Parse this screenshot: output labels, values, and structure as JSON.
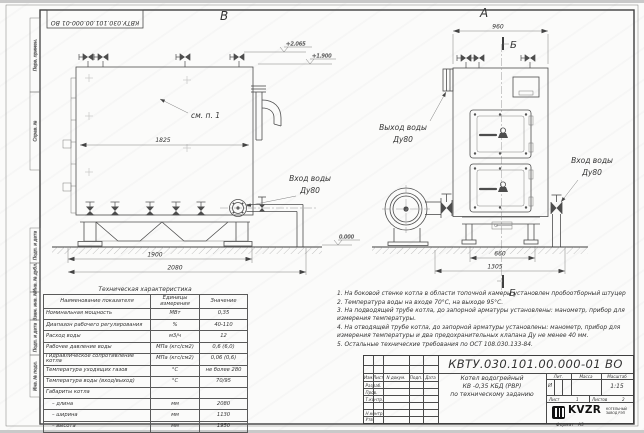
{
  "margin_fields": {
    "perv_primen": "Перв. примен.",
    "sprav_no": "Справ. №",
    "podp_data_1": "Подп. и дата",
    "inv_dubl": "Инв. № дубл.",
    "vzam_inv": "Взам. инв. №",
    "podp_data_2": "Подп. и дата",
    "inv_podl": "Инв. № подл."
  },
  "drawing": {
    "view_b_label": "В",
    "view_a_label": "А",
    "section_label": "Б",
    "see_note": "см. п. 1",
    "labels": {
      "inlet_line1": "Вход воды",
      "outlet_line1": "Выход воды",
      "dn": "Ду80"
    },
    "dims": {
      "d1825": "1825",
      "d1900": "1900",
      "d2080": "2080",
      "d960": "960",
      "d660": "660",
      "d1305": "1305"
    },
    "elevations": {
      "top": "+2.065",
      "mid": "+1.900",
      "ground": "0.000"
    }
  },
  "tech_table": {
    "title": "Техническая характеристика",
    "headers": [
      "Наименование показателя",
      "Единицы измерения",
      "Значение"
    ],
    "rows": [
      [
        "Номинальная мощность",
        "МВт",
        "0,35"
      ],
      [
        "Диапазон рабочего регулирования",
        "%",
        "40-110"
      ],
      [
        "Расход воды",
        "м3/ч",
        "12"
      ],
      [
        "Рабочее давление воды",
        "МПа (кгс/см2)",
        "0,6 (6,0)"
      ],
      [
        "Гидравлическое сопротивление котла",
        "МПа (кгс/см2)",
        "0,06 (0,6)"
      ],
      [
        "Температура уходящих газов",
        "°С",
        "не более 280"
      ],
      [
        "Температура воды (вход/выход)",
        "°С",
        "70/95"
      ],
      [
        "Габариты котла",
        "",
        ""
      ],
      [
        "– длина",
        "мм",
        "2080"
      ],
      [
        "– ширина",
        "мм",
        "1130"
      ],
      [
        "– высота",
        "мм",
        "1950"
      ]
    ]
  },
  "notes": [
    "1. На боковой стенке котла в области топочной камеры установлен пробоотборный штуцер",
    "2. Температура воды на входе 70°С, на выходе 95°С.",
    "3. На подводящей трубе котла, до запорной арматуры установлены: манометр, прибор для измерения температуры.",
    "4. На отводящей трубе котла, до запорной арматуры установлены: манометр, прибор для измерения температуры и два предохранительных клапана Ду не менее 40 мм.",
    "5. Остальные технические требования по ОСТ 108.030.133-84."
  ],
  "title_block": {
    "doc_number": "КВТУ.030.101.00.000-01 ВО",
    "change_cols": [
      "Изм.",
      "Лист",
      "N докум.",
      "Подп.",
      "Дата"
    ],
    "row_labels": [
      "Разраб.",
      "Пров.",
      "Т.контр.",
      "Н.контр.",
      "Утв."
    ],
    "product_name_lines": [
      "Котел водогрейный",
      "КВ -0,35  КБД  (РВР)",
      "по техническому заданию"
    ],
    "lit_header": "Лит.",
    "mass_header": "Масса",
    "scale_header": "Масштаб",
    "lit_value": "И",
    "scale_value": "1:15",
    "sheet_label": "Лист",
    "sheet_value": "1",
    "sheets_label": "Листов",
    "sheets_value": "2",
    "logo_text": "KVZR",
    "logo_sub1": "КОТЕЛЬНЫЙ",
    "logo_sub2": "ЗАВОД РЭП",
    "format_label": "Формат",
    "format_value": "А3"
  }
}
